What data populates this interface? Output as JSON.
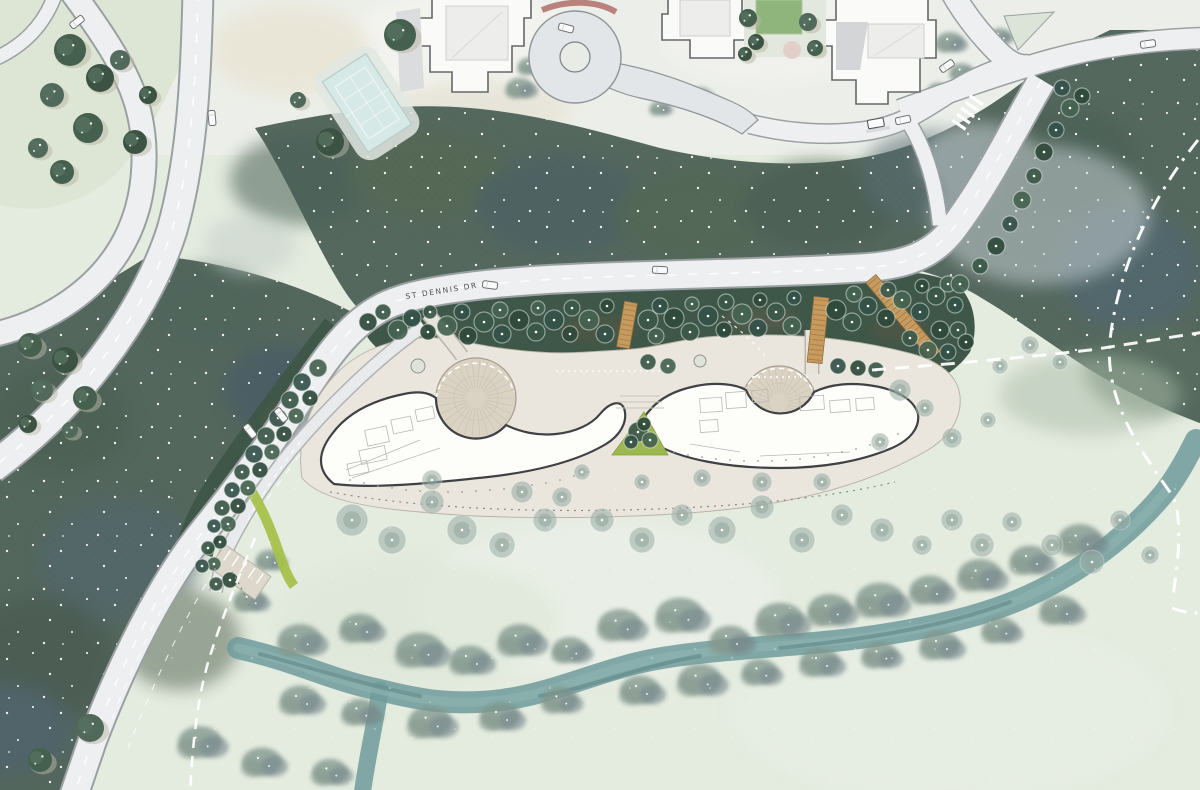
{
  "map": {
    "title": "Landscape site plan",
    "road_label": "ST DENNIS DR",
    "palette": {
      "meadow": "#e4ebdf",
      "upper_ground": "#ecefe9",
      "forest": "#54675c",
      "forest_shadow": "#46586b",
      "planting_band": "#3e5748",
      "tree_canopy_dark": "#2f4a3b",
      "soft_tree": "#93a79e",
      "road_fill": "#edeff1",
      "road_casing": "#9aa0a2",
      "stream": "#6f9b9b",
      "plaza_paving": "#dad2c2",
      "building_fill": "#fdfdfa",
      "building_outline": "#3f4145",
      "boardwalk": "#c79a5e",
      "lawn_accent": "#a6c24c",
      "tennis_court": "#d7e9e6",
      "trail_dash": "#ffffff",
      "courtyard_lawn": "#8fb57c"
    }
  }
}
